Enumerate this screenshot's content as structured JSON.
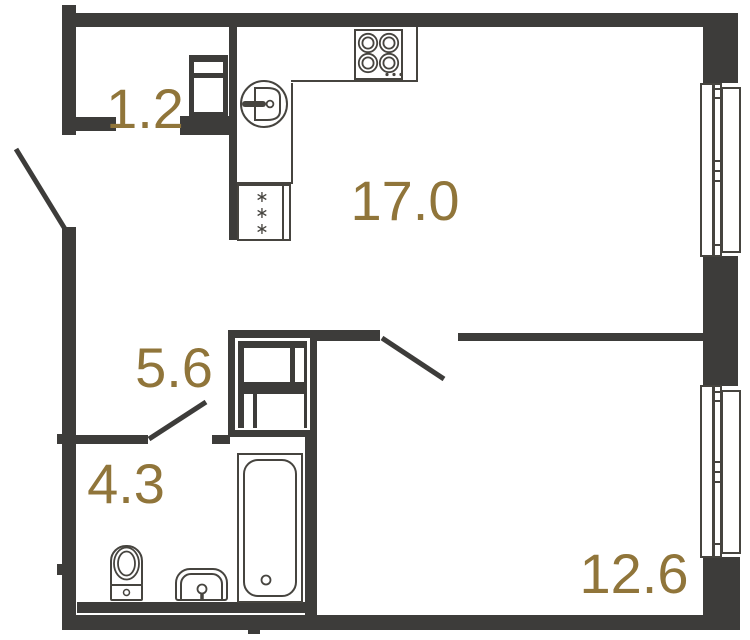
{
  "floorplan": {
    "type": "apartment-floor-plan",
    "rooms": [
      {
        "name": "entry-closet",
        "area_label": "1.2"
      },
      {
        "name": "kitchen-living-room",
        "area_label": "17.0"
      },
      {
        "name": "hallway",
        "area_label": "5.6"
      },
      {
        "name": "bathroom",
        "area_label": "4.3"
      },
      {
        "name": "bedroom",
        "area_label": "12.6"
      }
    ],
    "glyphs": {
      "snowflake": "∗"
    },
    "fixtures": [
      "stove-icon",
      "kitchen-sink-icon",
      "refrigerator-icon",
      "vent-shaft-icon",
      "wardrobe-icon",
      "bathtub-icon",
      "toilet-icon",
      "washbasin-icon",
      "window-icon",
      "door-swing-icon"
    ],
    "colors": {
      "wall": "#3d3c3a",
      "fixture_line": "#46443f",
      "label": "#90753a",
      "background": "#ffffff"
    }
  }
}
